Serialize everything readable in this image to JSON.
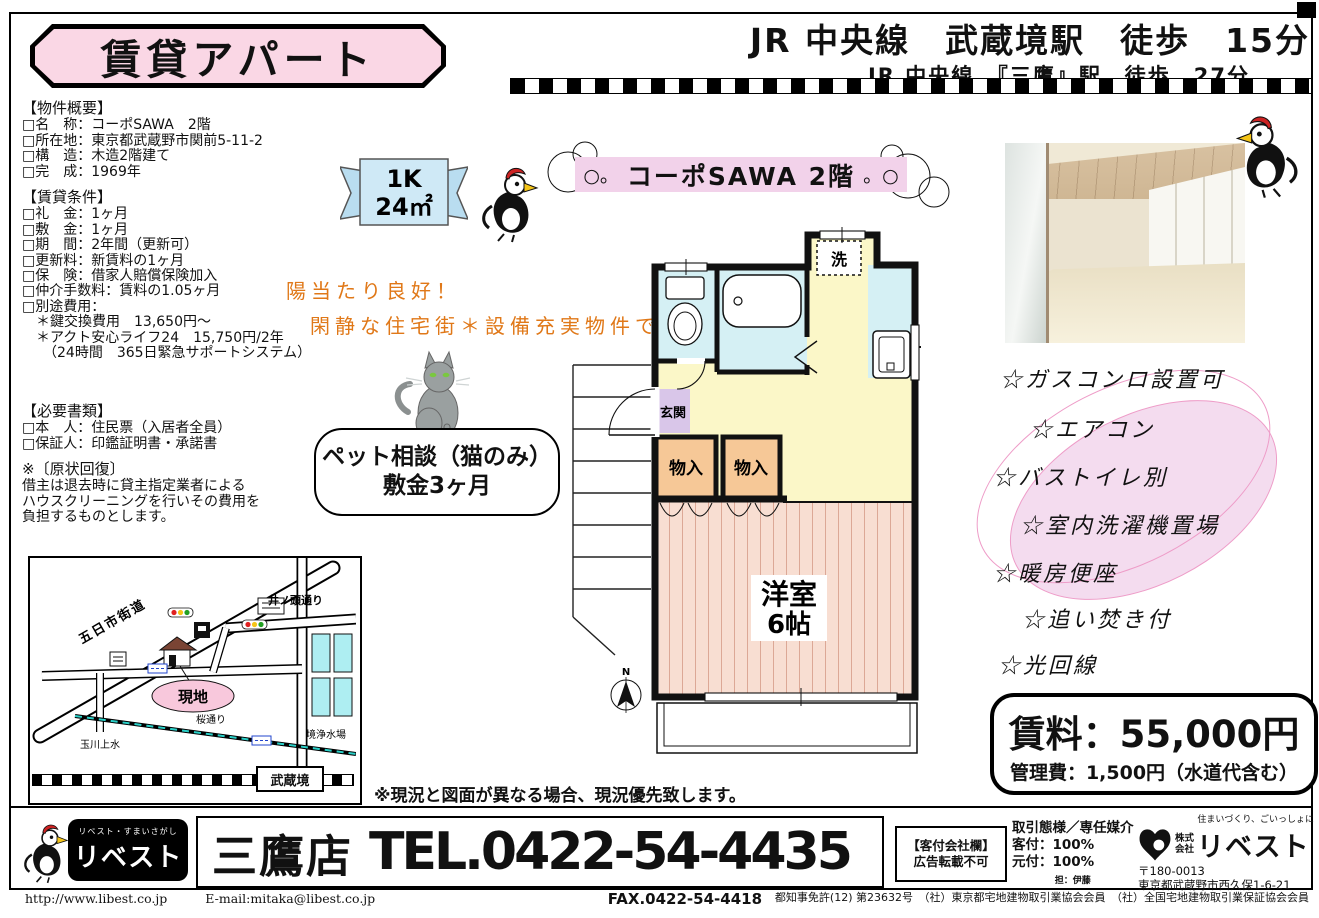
{
  "header": {
    "title": "賃貸アパート",
    "access_line1": "JR 中央線　武蔵境駅　徒歩　15分",
    "access_line2": "JR 中央線　『三鷹』駅　徒歩　27分"
  },
  "overview": {
    "heading": "【物件概要】",
    "items": [
      "□名　称：コーポSAWA　2階",
      "□所在地：東京都武蔵野市関前5-11-2",
      "□構　造：木造2階建て",
      "□完　成：1969年"
    ]
  },
  "conditions": {
    "heading": "【賃貸条件】",
    "items": [
      "□礼　金：1ヶ月",
      "□敷　金：1ヶ月",
      "□期　間：2年間（更新可）",
      "□更新料：新賃料の1ヶ月",
      "□保　険：借家人賠償保険加入",
      "□仲介手数料：賃料の1.05ヶ月",
      "□別途費用：",
      "　＊鍵交換費用　13,650円～",
      "　＊アクト安心ライフ24　15,750円/2年",
      "　　（24時間　365日緊急サポートシステム）"
    ]
  },
  "documents": {
    "heading": "【必要書類】",
    "items": [
      "□本　人：住民票（入居者全員）",
      "□保証人：印鑑証明書・承諾書"
    ]
  },
  "restoration": {
    "heading": "※〔原状回復〕",
    "lines": [
      "借主は退去時に貸主指定業者による",
      "ハウスクリーニングを行いその費用を",
      "負担するものとします。"
    ]
  },
  "badge": {
    "type": "1K",
    "area": "24㎡"
  },
  "banner": {
    "deco_left": "○。",
    "title": "コーポSAWA 2階",
    "deco_right": "。○"
  },
  "catch_copy": {
    "line1": "陽当たり良好！",
    "line2": "閑静な住宅街＊設備充実物件です"
  },
  "pet_note": {
    "line1": "ペット相談（猫のみ）",
    "line2": "敷金3ヶ月"
  },
  "floor_plan": {
    "washer": "洗",
    "entrance": "玄関",
    "closet1": "物入",
    "closet2": "物入",
    "room_name": "洋室",
    "room_size": "6帖",
    "north": "N"
  },
  "features": [
    "☆ガスコンロ設置可",
    "☆エアコン",
    "☆バストイレ別",
    "☆室内洗濯機置場",
    "☆暖房便座",
    "☆追い焚き付",
    "☆光回線"
  ],
  "price": {
    "rent": "賃料：55,000円",
    "management": "管理費：1,500円（水道代含む）"
  },
  "disclaimer": "※現況と図面が異なる場合、現況優先致します。",
  "map": {
    "road_itsukaichi": "五日市街道",
    "road_inokashira": "井ノ頭通り",
    "road_sakura": "桜通り",
    "water_tamagawa": "玉川上水",
    "facility_josuijo": "境浄水場",
    "site": "現地",
    "station": "武蔵境"
  },
  "footer": {
    "logo_tagline": "リベスト・すまいさがし",
    "logo_name": "リベスト",
    "store": "三鷹店",
    "tel": "TEL.0422-54-4435",
    "fax": "FAX.0422-54-4418",
    "agent_line1": "【客付会社欄】",
    "agent_line2": "広告転載不可",
    "deal_line1": "取引態様／専任媒介",
    "deal_line2": "客付：100%",
    "deal_line3": "元付：100%",
    "deal_person": "担：伊藤",
    "company_tagline": "住まいづくり、ごいっしょに",
    "company_prefix1": "株式",
    "company_prefix2": "会社",
    "company_name": "リベスト",
    "postal": "〒180-0013",
    "address": "東京都武蔵野市西久保1-6-21",
    "license": "都知事免許(12) 第23632号　（社）東京都宅地建物取引業協会会員　（社）全国宅地建物取引業保証協会会員",
    "url": "http://www.libest.co.jp",
    "email": "E-mail:mitaka@libest.co.jp"
  },
  "colors": {
    "title_pink": "#fad7e5",
    "banner_pink": "#f2d2ea",
    "badge_blue": "#cfe9f6",
    "plan_yellow": "#fbf7c8",
    "plan_cyan": "#d5f0f4",
    "plan_orange": "#f6c897",
    "plan_room_pink": "#f8ded2",
    "entrance_purple": "#d9c6e9",
    "accent_orange": "#e07818",
    "feature_ellipse": "#f4dcef",
    "site_pink": "#f8c8dc",
    "map_water_cyan": "#aeeef2"
  }
}
